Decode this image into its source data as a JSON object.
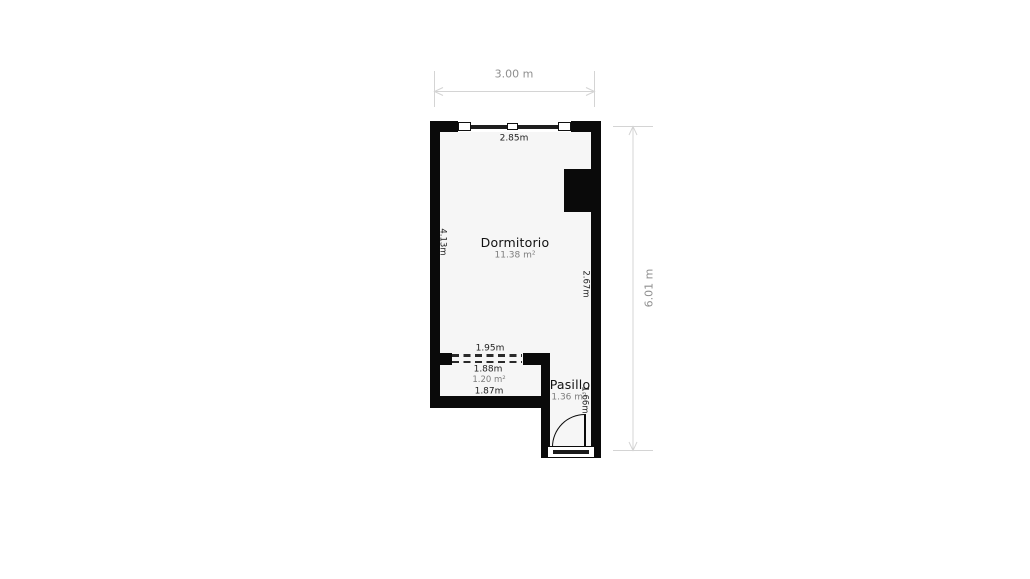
{
  "plan": {
    "rooms": {
      "dormitorio": {
        "name": "Dormitorio",
        "area": "11.38 m²"
      },
      "pasillo": {
        "name": "Pasillo",
        "area": "1.36 m²"
      },
      "closet": {
        "area": "1.20 m²"
      }
    },
    "wall_measurements": {
      "top_wall": "2.85m",
      "left_wall": "4.13m",
      "right_wall": "2.67m",
      "opening": "1.95m",
      "closet_top": "1.88m",
      "closet_bottom": "1.87m",
      "pasillo_right_wall": "1.66m"
    },
    "outer_dimensions": {
      "width": "3.00 m",
      "height": "6.01 m"
    }
  },
  "colors": {
    "wall": "#0a0a0a",
    "floor": "#f6f6f6",
    "dim_line": "#d4d4d4",
    "dim_text": "#8f8f8f",
    "room_text": "#111111",
    "area_text": "#7d7d7d",
    "measure_text": "#222222",
    "canvas_bg": "#ffffff"
  }
}
